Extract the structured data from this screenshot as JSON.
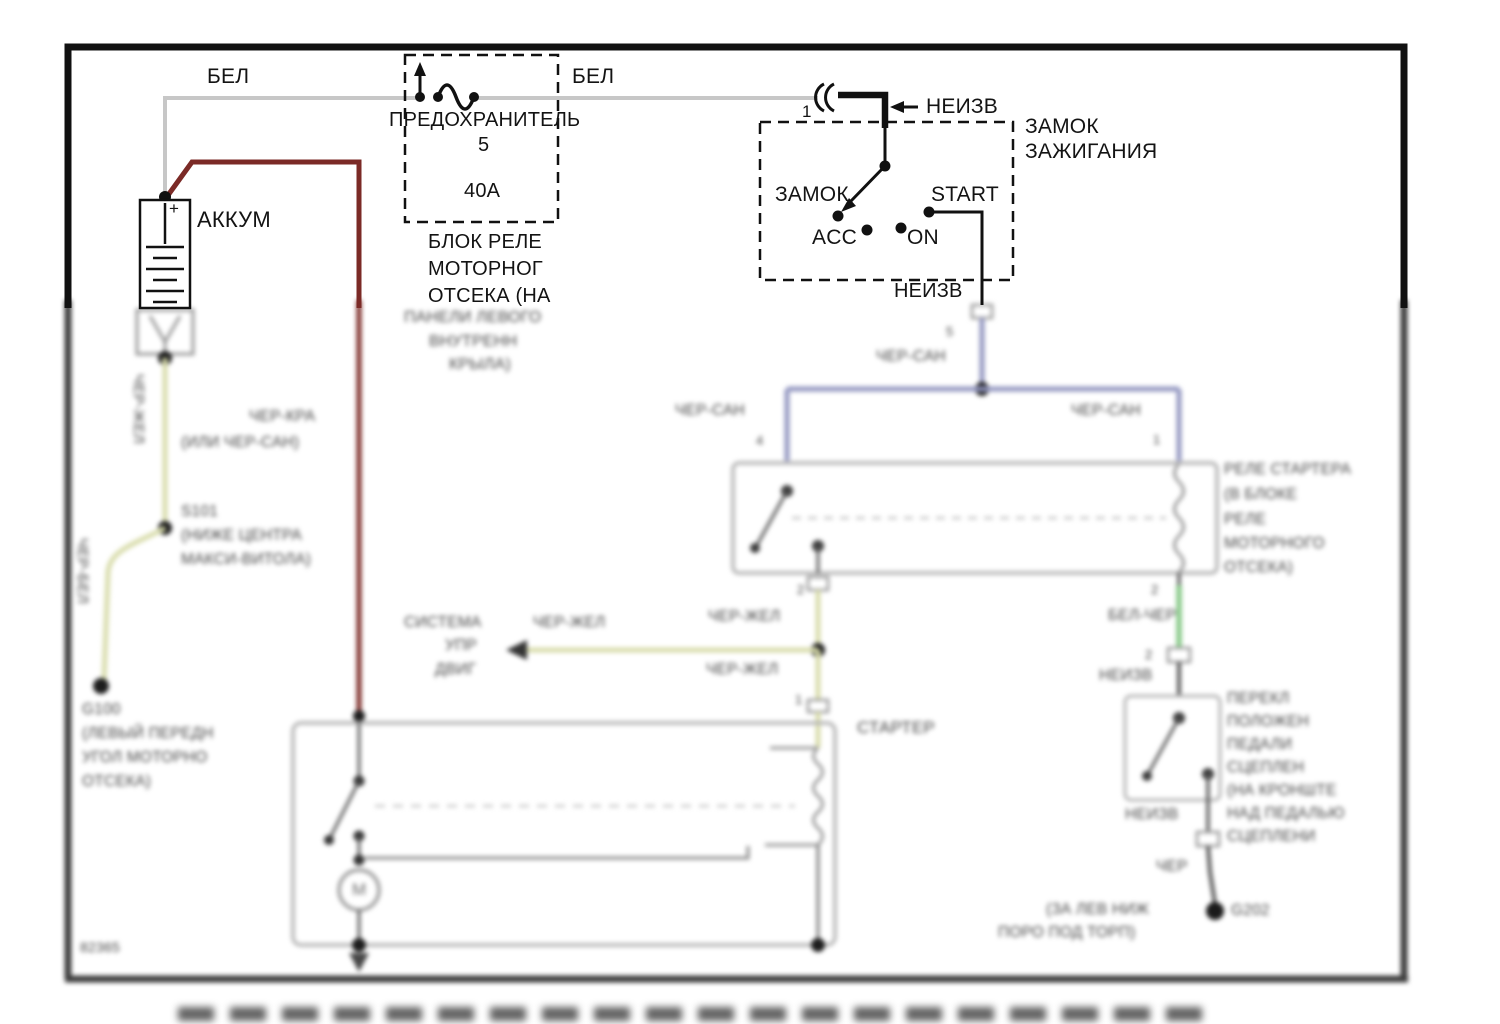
{
  "colors": {
    "ink": "#131313",
    "wire_white": "#c7c7c7",
    "wire_red": "#7b2a26",
    "wire_yellowgreen": "#d8dcab",
    "wire_blue": "#9296c0",
    "wire_green": "#87c987",
    "wire_dark": "#4f4f4f",
    "box_gray": "#b4b4b4",
    "dot_dark": "#1d1d1d"
  },
  "labels": [
    {
      "name": "wire-label-bel-left",
      "text": "БЕЛ",
      "x": 207,
      "y": 66,
      "s": 21,
      "blur": false
    },
    {
      "name": "wire-label-bel-right",
      "text": "БЕЛ",
      "x": 572,
      "y": 66,
      "s": 21,
      "blur": false
    },
    {
      "name": "fuse-title",
      "text": "ПРЕДОХРАНИТЕЛЬ",
      "x": 389,
      "y": 110,
      "s": 20,
      "blur": false
    },
    {
      "name": "fuse-number",
      "text": "5",
      "x": 478,
      "y": 135,
      "s": 20,
      "blur": false
    },
    {
      "name": "fuse-rating",
      "text": "40А",
      "x": 464,
      "y": 181,
      "s": 20,
      "blur": false
    },
    {
      "name": "fuse-block-name-line1",
      "text": "БЛОК РЕЛЕ",
      "x": 428,
      "y": 232,
      "s": 20,
      "blur": false
    },
    {
      "name": "fuse-block-name-line2",
      "text": "МОТОРНОГ",
      "x": 428,
      "y": 259,
      "s": 20,
      "blur": false
    },
    {
      "name": "fuse-block-name-line3",
      "text": "ОТСЕКА (НА",
      "x": 428,
      "y": 286,
      "s": 20,
      "blur": false
    },
    {
      "name": "battery-label",
      "text": "АККУМ",
      "x": 197,
      "y": 208,
      "s": 22,
      "blur": false
    },
    {
      "name": "battery-plus",
      "text": "+",
      "x": 169,
      "y": 200,
      "s": 17,
      "blur": false
    },
    {
      "name": "ignition-connector-pin",
      "text": "1",
      "x": 802,
      "y": 103,
      "s": 17,
      "blur": false
    },
    {
      "name": "feed-label-neizv",
      "text": "НЕИЗВ",
      "x": 926,
      "y": 96,
      "s": 21,
      "blur": false
    },
    {
      "name": "ignition-title-line1",
      "text": "ЗАМОК",
      "x": 1025,
      "y": 116,
      "s": 21,
      "blur": false
    },
    {
      "name": "ignition-title-line2",
      "text": "ЗАЖИГАНИЯ",
      "x": 1025,
      "y": 141,
      "s": 21,
      "blur": false
    },
    {
      "name": "position-lock",
      "text": "ЗАМОК",
      "x": 775,
      "y": 184,
      "s": 21,
      "blur": false
    },
    {
      "name": "position-start",
      "text": "START",
      "x": 931,
      "y": 184,
      "s": 21,
      "blur": false
    },
    {
      "name": "position-acc",
      "text": "ACC",
      "x": 812,
      "y": 227,
      "s": 21,
      "blur": false
    },
    {
      "name": "position-on",
      "text": "ON",
      "x": 907,
      "y": 227,
      "s": 21,
      "blur": false
    },
    {
      "name": "ignition-output-neizv",
      "text": "НЕИЗВ",
      "x": 894,
      "y": 281,
      "s": 20,
      "blur": false
    },
    {
      "name": "fuse-block-loc-line1",
      "text": "ПАНЕЛИ ЛЕВОГО",
      "x": 404,
      "y": 310,
      "s": 16,
      "blur": true
    },
    {
      "name": "fuse-block-loc-line2",
      "text": "ВНУТРЕНН",
      "x": 429,
      "y": 334,
      "s": 16,
      "blur": true
    },
    {
      "name": "fuse-block-loc-line3",
      "text": "КРЫЛА)",
      "x": 449,
      "y": 357,
      "s": 16,
      "blur": true
    },
    {
      "name": "connector-pin-5",
      "text": "5",
      "x": 946,
      "y": 325,
      "s": 13,
      "blur": true
    },
    {
      "name": "wire-label-cher-san-1",
      "text": "ЧЕР-САН",
      "x": 876,
      "y": 349,
      "s": 15.5,
      "blur": true
    },
    {
      "name": "wire-label-cher-san-2",
      "text": "ЧЕР-САН",
      "x": 675,
      "y": 403,
      "s": 15.5,
      "blur": true
    },
    {
      "name": "wire-label-cher-san-3",
      "text": "ЧЕР-САН",
      "x": 1071,
      "y": 403,
      "s": 15.5,
      "blur": true
    },
    {
      "name": "relay-pin-4",
      "text": "4",
      "x": 756,
      "y": 434,
      "s": 13,
      "blur": true
    },
    {
      "name": "relay-pin-1",
      "text": "1",
      "x": 1153,
      "y": 433,
      "s": 13,
      "blur": true
    },
    {
      "name": "relay-name-line1",
      "text": "РЕЛЕ СТАРТЕРА",
      "x": 1224,
      "y": 462,
      "s": 15.5,
      "blur": true
    },
    {
      "name": "relay-name-line2",
      "text": "(В БЛОКЕ",
      "x": 1224,
      "y": 487,
      "s": 15.5,
      "blur": true
    },
    {
      "name": "relay-name-line3",
      "text": "РЕЛЕ",
      "x": 1224,
      "y": 512,
      "s": 15.5,
      "blur": true
    },
    {
      "name": "relay-name-line4",
      "text": "МОТОРНОГО",
      "x": 1224,
      "y": 536,
      "s": 15.5,
      "blur": true
    },
    {
      "name": "relay-name-line5",
      "text": "ОТСЕКА)",
      "x": 1224,
      "y": 560,
      "s": 15.5,
      "blur": true
    },
    {
      "name": "relay-pin-2-left",
      "text": "2",
      "x": 797,
      "y": 583,
      "s": 13,
      "blur": true
    },
    {
      "name": "relay-pin-2-right",
      "text": "2",
      "x": 1151,
      "y": 583,
      "s": 13,
      "blur": true
    },
    {
      "name": "wire-label-cher-zhel-1",
      "text": "ЧЕР-ЖЕЛ",
      "x": 708,
      "y": 609,
      "s": 15.5,
      "blur": true
    },
    {
      "name": "wire-label-bel-cher",
      "text": "БЕЛ-ЧЕР",
      "x": 1108,
      "y": 608,
      "s": 15.5,
      "blur": true
    },
    {
      "name": "clutch-connector-pin",
      "text": "2",
      "x": 1145,
      "y": 648,
      "s": 13,
      "blur": true
    },
    {
      "name": "clutch-neizv-top",
      "text": "НЕИЗВ",
      "x": 1099,
      "y": 668,
      "s": 15.5,
      "blur": true
    },
    {
      "name": "clutch-switch-name-line1",
      "text": "ПЕРЕКЛ",
      "x": 1227,
      "y": 691,
      "s": 15.5,
      "blur": true
    },
    {
      "name": "clutch-switch-name-line2",
      "text": "ПОЛОЖЕН",
      "x": 1227,
      "y": 714,
      "s": 15.5,
      "blur": true
    },
    {
      "name": "clutch-switch-name-line3",
      "text": "ПЕДАЛИ",
      "x": 1227,
      "y": 737,
      "s": 15.5,
      "blur": true
    },
    {
      "name": "clutch-switch-name-line4",
      "text": "СЦЕПЛЕН",
      "x": 1227,
      "y": 760,
      "s": 15.5,
      "blur": true
    },
    {
      "name": "clutch-switch-name-line5",
      "text": "(НА КРОНШТЕ",
      "x": 1227,
      "y": 783,
      "s": 15.5,
      "blur": true
    },
    {
      "name": "clutch-switch-name-line6",
      "text": "НАД ПЕДАЛЬЮ",
      "x": 1227,
      "y": 806,
      "s": 15.5,
      "blur": true
    },
    {
      "name": "clutch-switch-name-line7",
      "text": "СЦЕПЛЕНИ",
      "x": 1227,
      "y": 829,
      "s": 15.5,
      "blur": true
    },
    {
      "name": "clutch-neizv-bottom",
      "text": "НЕИЗВ",
      "x": 1125,
      "y": 807,
      "s": 15.5,
      "blur": true
    },
    {
      "name": "wire-label-cher",
      "text": "ЧЕР",
      "x": 1156,
      "y": 859,
      "s": 15.5,
      "blur": true
    },
    {
      "name": "ground-g202",
      "text": "G202",
      "x": 1231,
      "y": 903,
      "s": 15.5,
      "blur": true
    },
    {
      "name": "g202-loc-line1",
      "text": "(ЗА ЛЕВ НИЖ",
      "x": 1046,
      "y": 902,
      "s": 15.5,
      "blur": true
    },
    {
      "name": "g202-loc-line2",
      "text": "ПОРО ПОД ТОРП)",
      "x": 998,
      "y": 925,
      "s": 15.5,
      "blur": true
    },
    {
      "name": "engine-system-line1",
      "text": "СИСТЕМА",
      "x": 404,
      "y": 615,
      "s": 15.5,
      "blur": true
    },
    {
      "name": "engine-system-line2",
      "text": "УПР",
      "x": 445,
      "y": 638,
      "s": 15.5,
      "blur": true
    },
    {
      "name": "engine-system-line3",
      "text": "ДВИГ",
      "x": 435,
      "y": 662,
      "s": 15.5,
      "blur": true
    },
    {
      "name": "wire-label-cher-zhel-2",
      "text": "ЧЕР-ЖЕЛ",
      "x": 533,
      "y": 615,
      "s": 15.5,
      "blur": true
    },
    {
      "name": "wire-label-cher-zhel-3",
      "text": "ЧЕР-ЖЕЛ",
      "x": 706,
      "y": 662,
      "s": 15.5,
      "blur": true
    },
    {
      "name": "starter-pin-1",
      "text": "1",
      "x": 795,
      "y": 693,
      "s": 13,
      "blur": true
    },
    {
      "name": "starter-label",
      "text": "СТАРТЕР",
      "x": 857,
      "y": 719,
      "s": 17,
      "blur": true
    },
    {
      "name": "wire-label-cher-zhel-vertical",
      "text": "ЧЕР-ЖЕЛ",
      "x": 146,
      "y": 374,
      "s": 15,
      "blur": true,
      "rot": 90
    },
    {
      "name": "wire-label-cher-bel-vertical",
      "text": "ЧЕР-БЕЛ",
      "x": 90,
      "y": 538,
      "s": 15,
      "blur": true,
      "rot": 90
    },
    {
      "name": "wire-label-cher-kra",
      "text": "ЧЕР-КРА",
      "x": 249,
      "y": 409,
      "s": 15.5,
      "blur": true
    },
    {
      "name": "wire-label-ili-cher-san",
      "text": "(ИЛИ ЧЕР-САН)",
      "x": 181,
      "y": 435,
      "s": 15.5,
      "blur": true
    },
    {
      "name": "splice-s101",
      "text": "S101",
      "x": 181,
      "y": 504,
      "s": 15.5,
      "blur": true
    },
    {
      "name": "s101-loc-line1",
      "text": "(НИЖЕ ЦЕНТРА",
      "x": 181,
      "y": 528,
      "s": 15.5,
      "blur": true
    },
    {
      "name": "s101-loc-line2",
      "text": "МАКСИ-ВИТОЛА)",
      "x": 181,
      "y": 552,
      "s": 15.5,
      "blur": true
    },
    {
      "name": "ground-g100",
      "text": "G100",
      "x": 82,
      "y": 702,
      "s": 15.5,
      "blur": true
    },
    {
      "name": "g100-loc-line1",
      "text": "(ЛЕВЫЙ ПЕРЕДН",
      "x": 82,
      "y": 726,
      "s": 15.5,
      "blur": true
    },
    {
      "name": "g100-loc-line2",
      "text": "УГОЛ МОТОРНО",
      "x": 82,
      "y": 750,
      "s": 15.5,
      "blur": true
    },
    {
      "name": "g100-loc-line3",
      "text": "ОТСЕКА)",
      "x": 82,
      "y": 774,
      "s": 15.5,
      "blur": true
    },
    {
      "name": "page-code",
      "text": "82365",
      "x": 80,
      "y": 940,
      "s": 14,
      "blur": true
    },
    {
      "name": "starter-motor-m",
      "text": "М",
      "x": 352,
      "y": 881,
      "s": 17,
      "blur": true,
      "c": "#6a6a6a"
    }
  ]
}
